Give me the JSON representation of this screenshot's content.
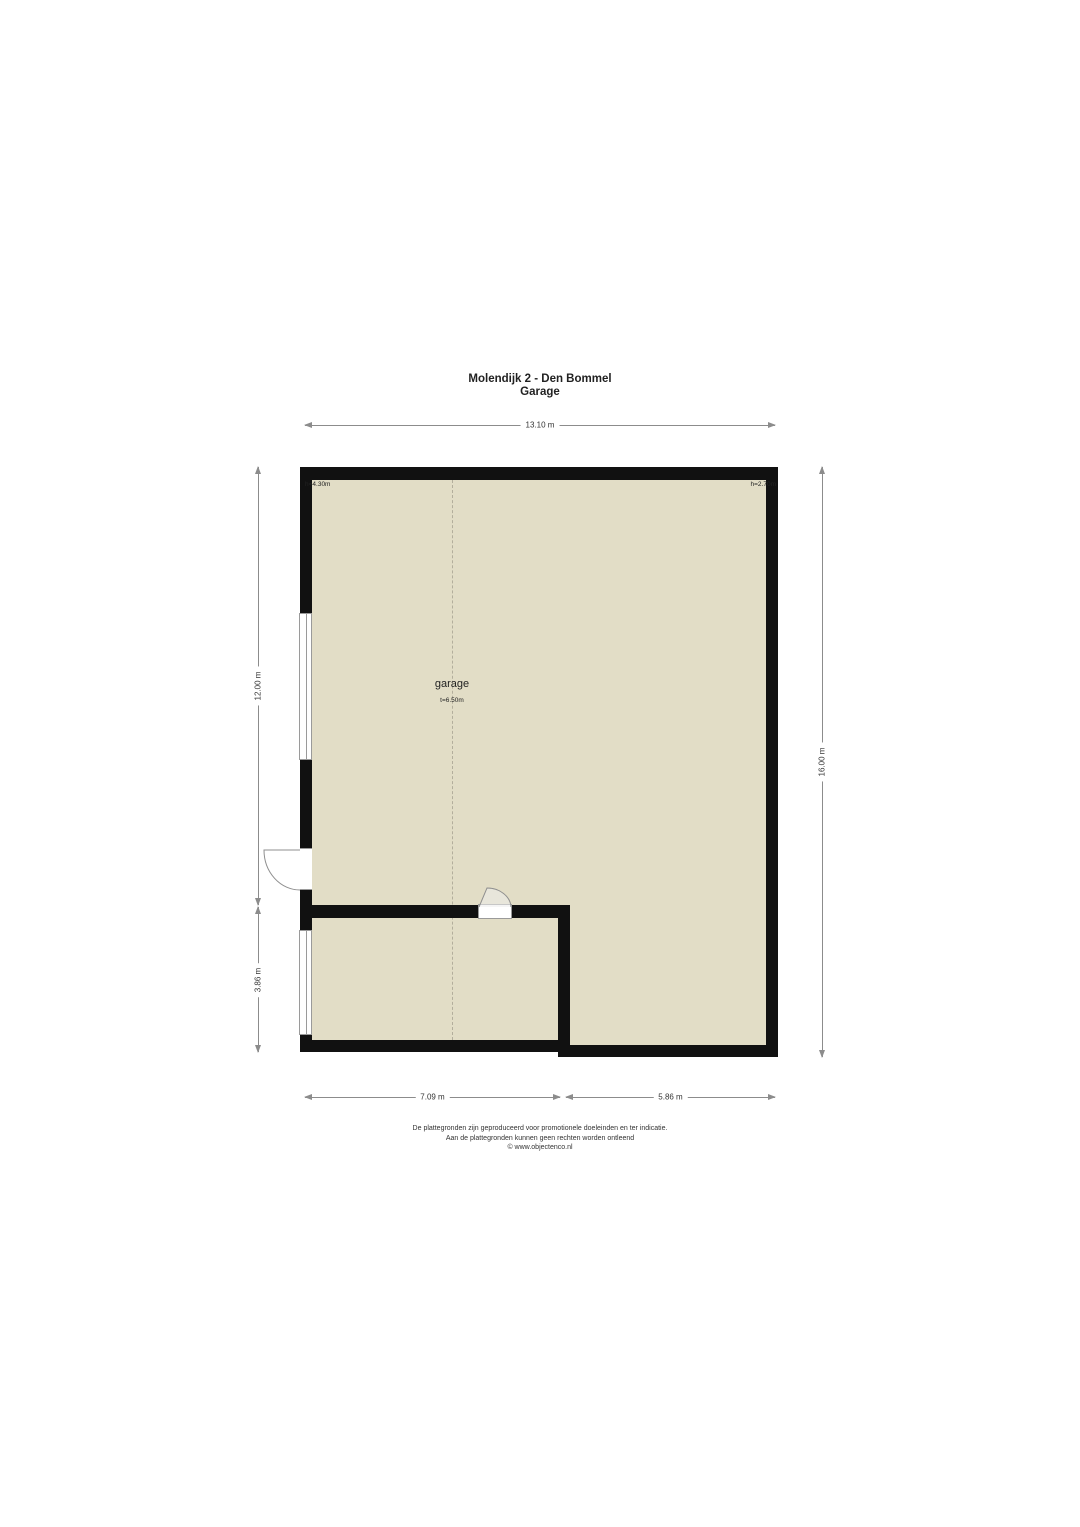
{
  "title": {
    "address": "Molendijk 2 - Den Bommel",
    "floor": "Garage"
  },
  "plan": {
    "room": {
      "name": "garage",
      "size_label": "t=6.50m"
    },
    "heights": {
      "top_left": "h=4.30m",
      "top_right": "h=2.70m"
    },
    "colors": {
      "wall": "#111111",
      "floor": "#e2ddc6",
      "dash_line": "#b3ae9c",
      "dimension": "#8c8c8c",
      "window_border": "#9a9a9a",
      "text": "#222222"
    }
  },
  "dimensions": {
    "top": "13.10 m",
    "left_upper": "12.00 m",
    "left_lower": "3.86 m",
    "right": "16.00 m",
    "bottom_left": "7.09 m",
    "bottom_right": "5.86 m"
  },
  "footer": {
    "line1": "De plattegronden zijn geproduceerd voor promotionele doeleinden en ter indicatie.",
    "line2": "Aan de plattegronden kunnen geen rechten worden ontleend",
    "line3": "© www.objectenco.nl"
  }
}
